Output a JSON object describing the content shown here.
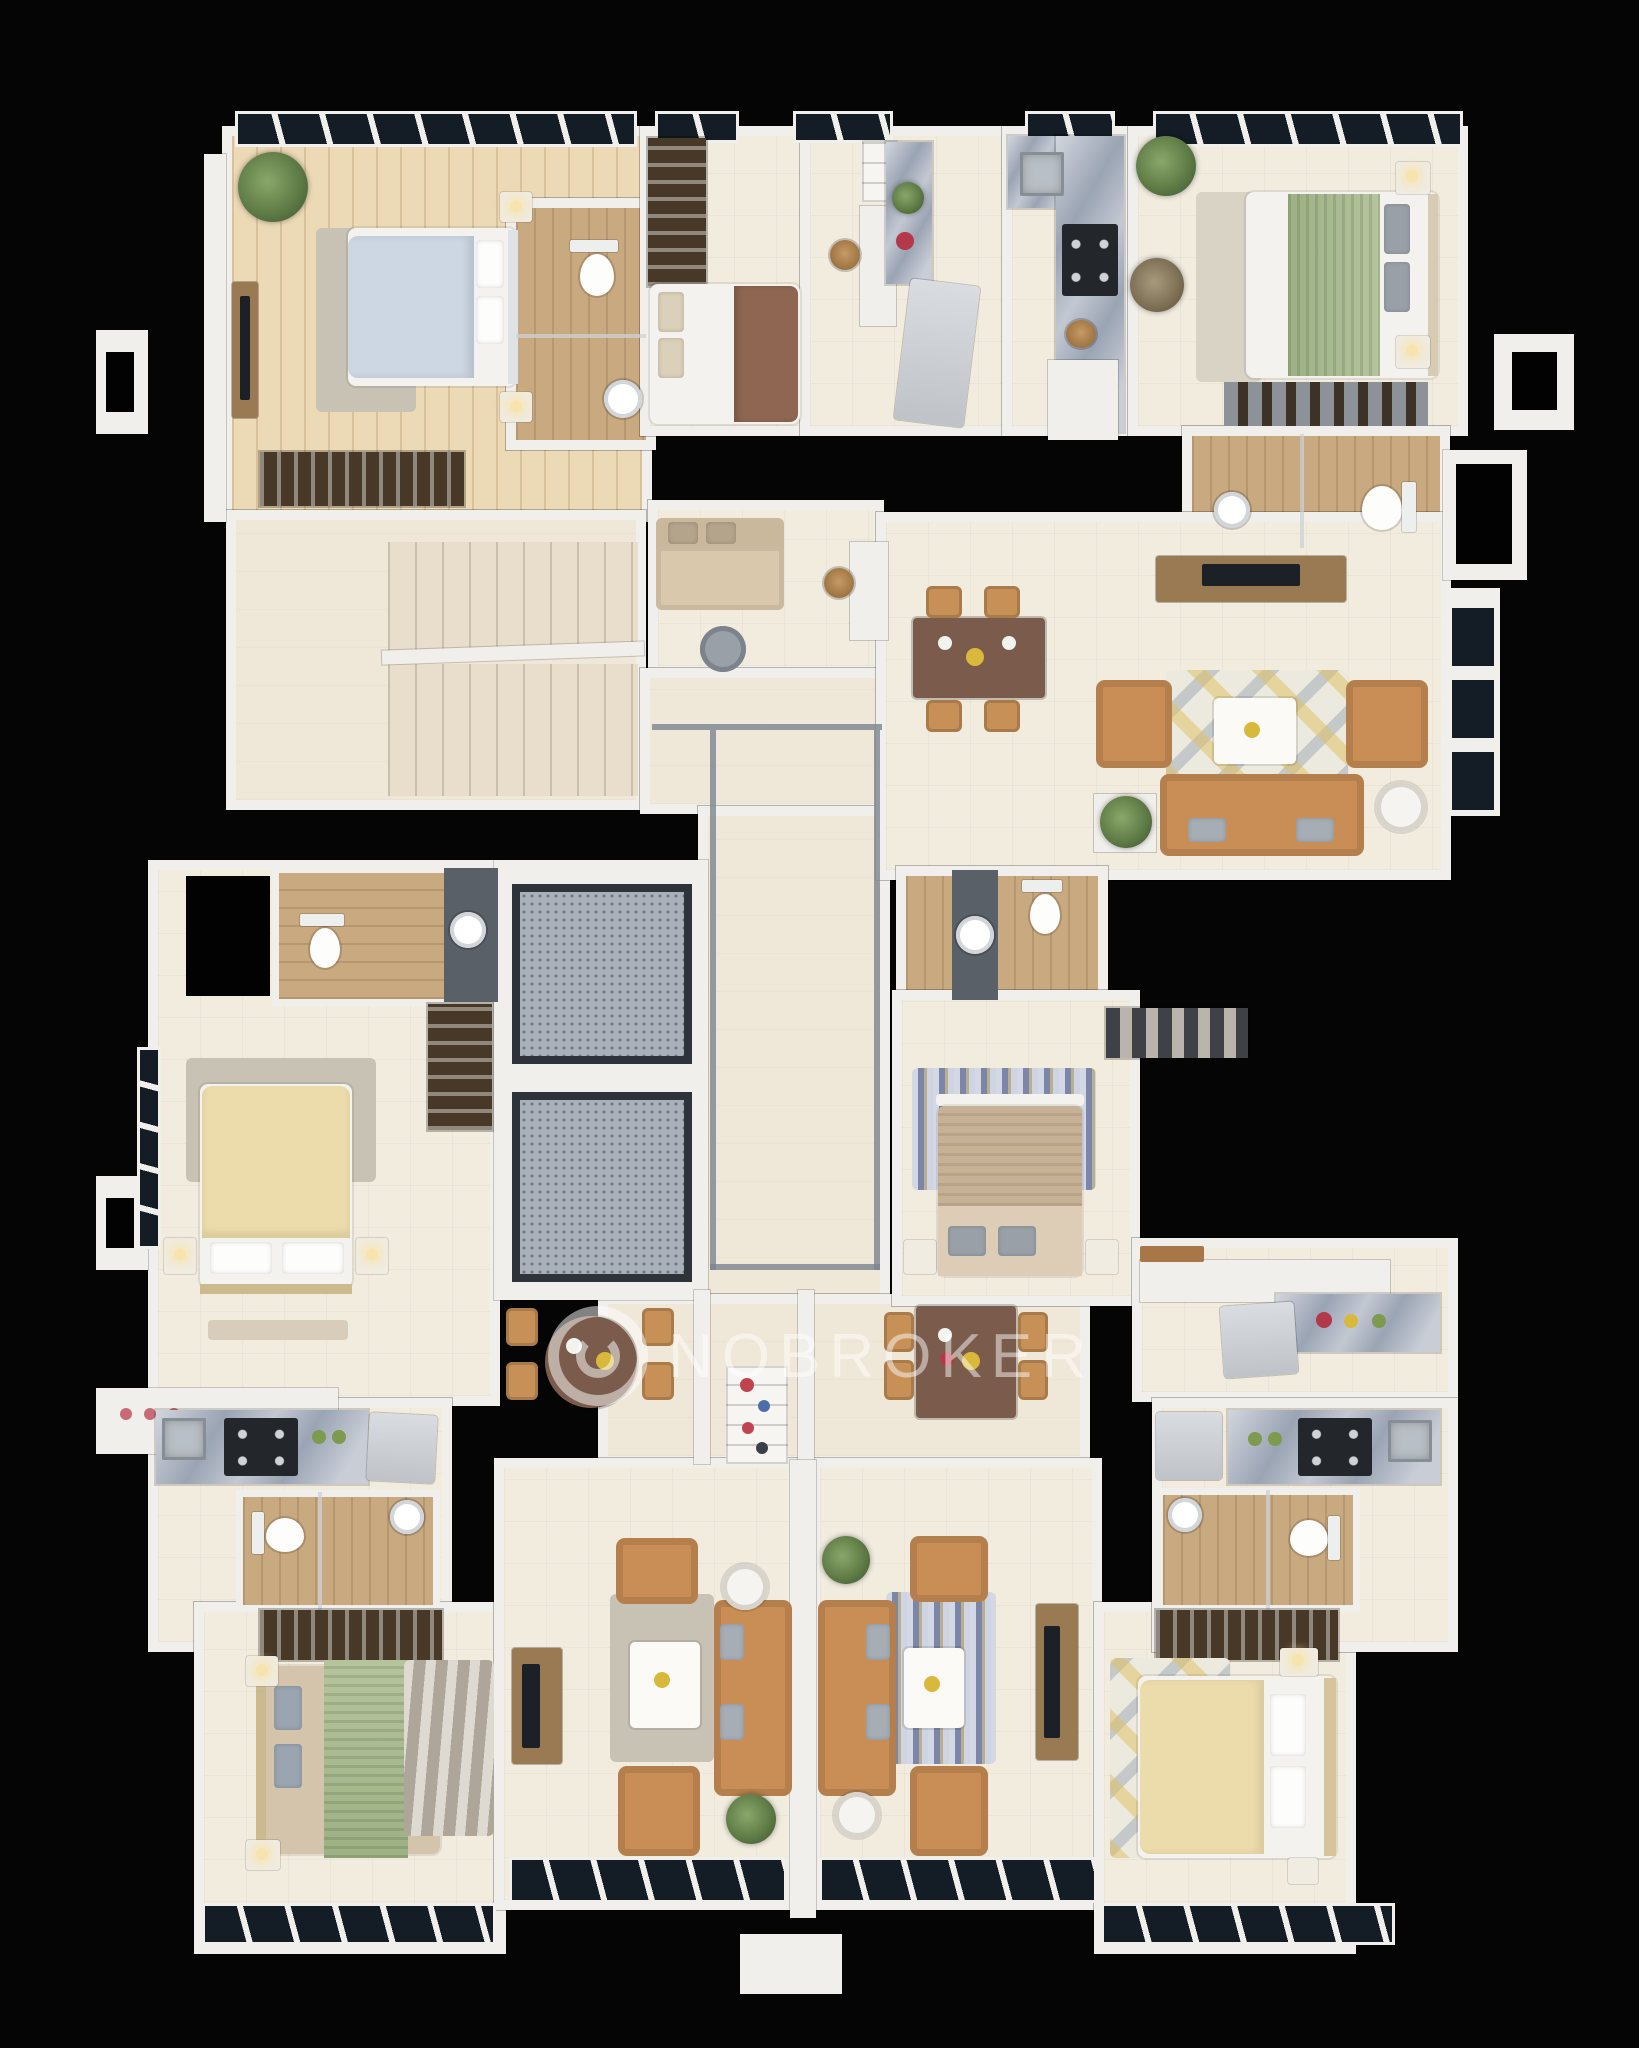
{
  "watermark": {
    "text": "NOBROKER",
    "logo": "nobroker-ring-logo"
  },
  "palette": {
    "background": "#050505",
    "wall": "#f1efeb",
    "floor_cream": "#f2ecdf",
    "floor_warm": "#efe7d8",
    "floor_plank": "#ecd9b6",
    "floor_bath_wood": "#c9a97f",
    "window_glass": "#141c26",
    "sofa_orange": "#c98e55",
    "sofa_beige": "#d9c8ac",
    "bed_blue": "#ccd7e3",
    "bed_brown": "#8f6652",
    "bed_tan": "#c7b195",
    "bed_cream": "#ecdcab",
    "throw_green": "#a5b98e",
    "rug_gray": "#c8c2b4",
    "rug_wave": "#c2bbae",
    "rug_chevron": "#9fa9c6",
    "rug_geo": "#eceade",
    "counter_marble": "#9ba4b4",
    "wardrobe_dark": "#473827",
    "corridor_trim": "#7b8490",
    "elevator_cab": "#aab0ba",
    "elevator_frame": "#2e333a",
    "stairs_tread": "#e9decb",
    "table_brown": "#7b5c4c",
    "chair_tan": "#c69057",
    "plant_green": "#5d7a45",
    "tv_dark": "#1c2127",
    "watermark_color": "rgba(255,255,255,0.5)"
  }
}
